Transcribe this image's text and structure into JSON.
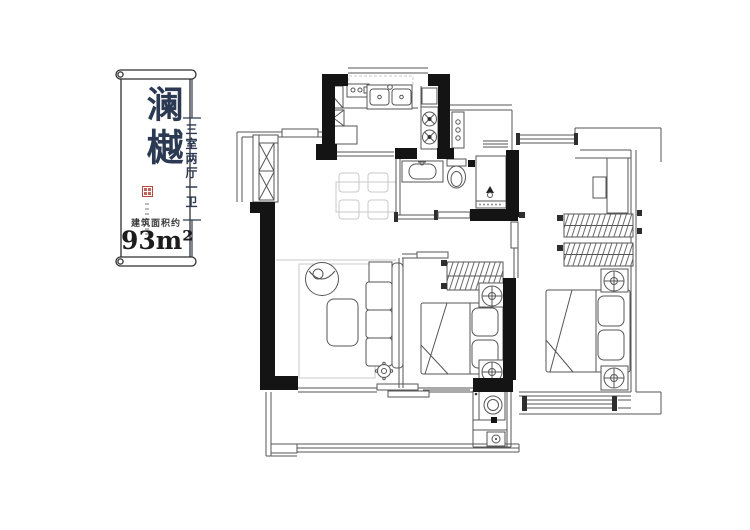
{
  "page": {
    "background": "#ffffff"
  },
  "label_card": {
    "brand_name": "澜樾",
    "layout_description": "三室两厅一卫",
    "area_label": "建筑面积约",
    "area_value": "93m²",
    "ink_color": "#2b3a52",
    "seal_color": "#b5493f"
  },
  "floor_plan": {
    "wall_color": "#141414",
    "line_color": "#565656",
    "faint_color": "#c9c9c9"
  }
}
